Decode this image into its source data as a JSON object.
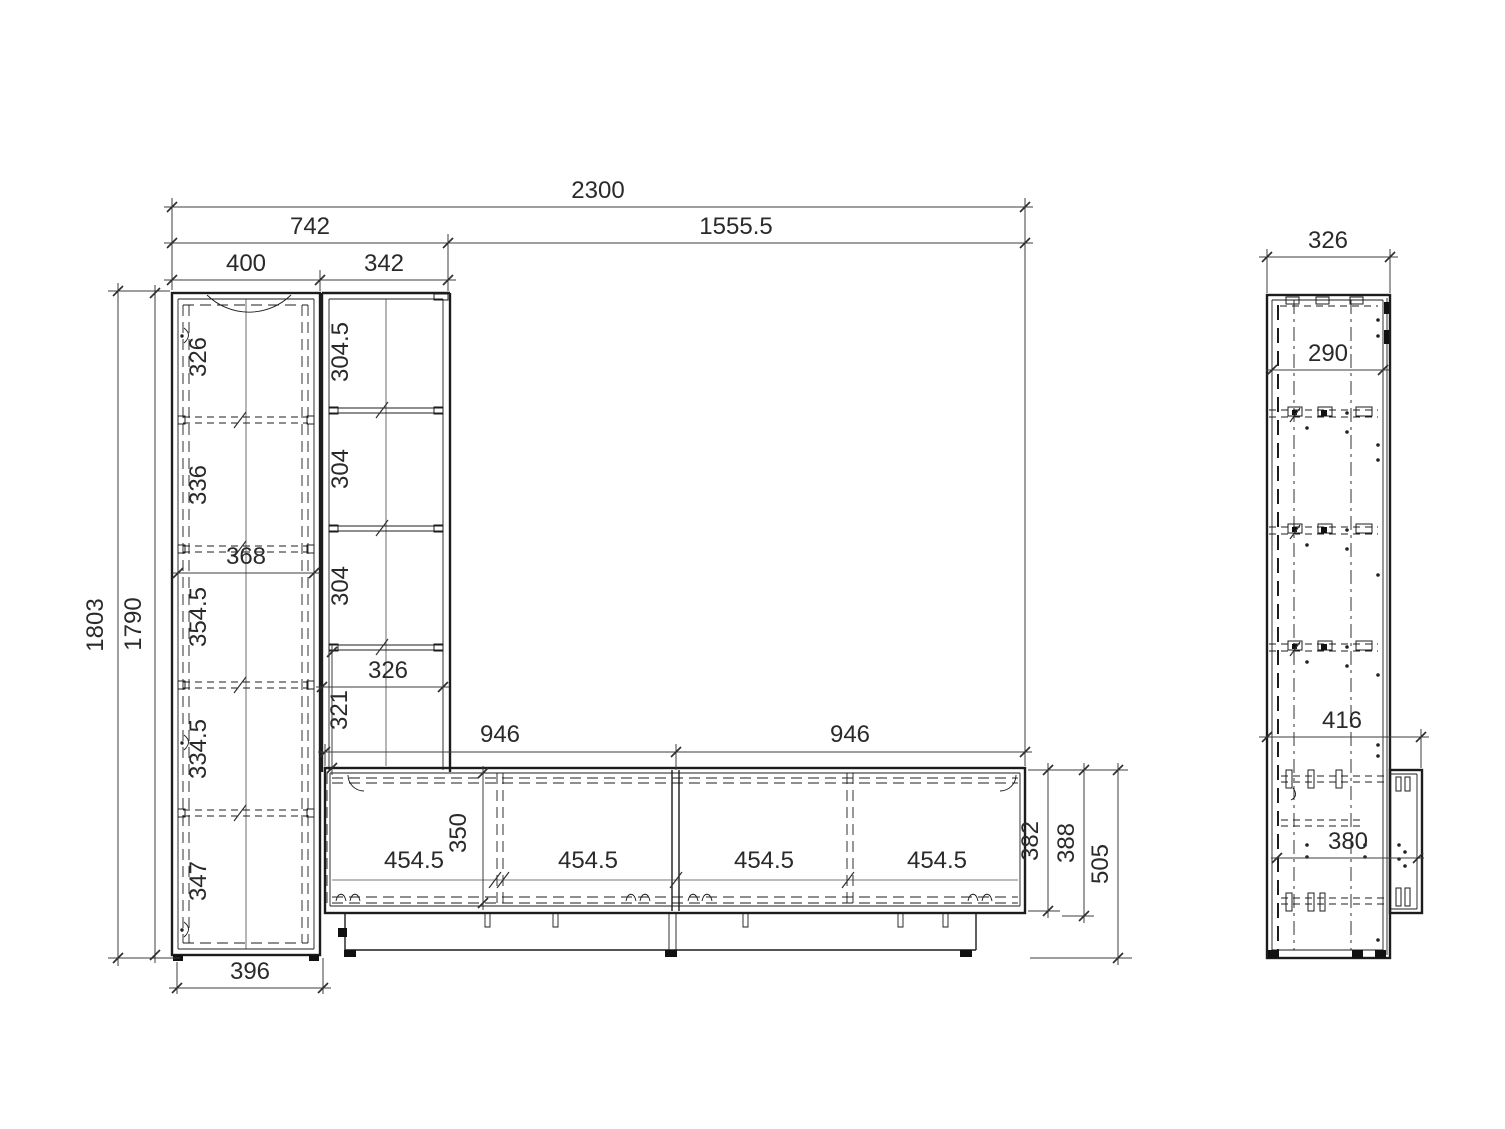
{
  "drawing": {
    "front": {
      "width_total": "2300",
      "width_left_section": "742",
      "width_right_section": "1555.5",
      "width_cabinet": "400",
      "width_column": "342",
      "height_outer": "1803",
      "height_carcass": "1790",
      "cabinet_compartments": [
        "326",
        "336",
        "354.5",
        "334.5",
        "347"
      ],
      "cabinet_inner_width": "368",
      "base_width": "396",
      "column_compartments": [
        "304.5",
        "304",
        "304",
        "321"
      ],
      "column_inner_width": "326",
      "lowboard_span_left": "946",
      "lowboard_span_right": "946",
      "lowboard_compartments": [
        "454.5",
        "454.5",
        "454.5",
        "454.5"
      ],
      "lowboard_inner_height": "350",
      "lowboard_carcass_height": "382",
      "lowboard_height": "388",
      "lowboard_total_height": "505"
    },
    "side": {
      "depth": "326",
      "inner_depth": "290",
      "total_depth_with_lowboard": "416",
      "lowboard_inner_depth": "380"
    }
  }
}
